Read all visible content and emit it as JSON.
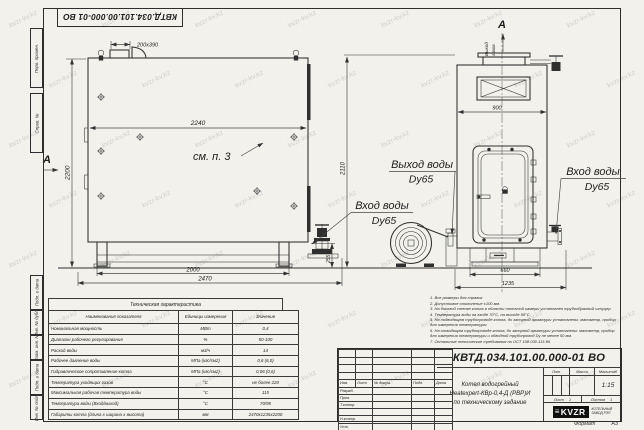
{
  "watermark": {
    "text": "kvzr-kv.kz"
  },
  "top_stamp": {
    "doc_number": "КВТД.034.101.00.000-01 ВО"
  },
  "frame_strip": {
    "labels": [
      "Перв. примен.",
      "Справ. №",
      "Подп. и дата",
      "Инв. № дубл.",
      "Взам. инв. №",
      "Подп. и дата",
      "Инв. № подл."
    ]
  },
  "drawing": {
    "section_letter": "А",
    "see_note": "см. п. 3",
    "gas_outlet_line1": "Выход",
    "gas_outlet_line2": "газов",
    "labels": {
      "inlet_line1": "Вход воды",
      "inlet_line2": "Dy65",
      "outlet_line1": "Выход воды",
      "outlet_line2": "Dy65"
    },
    "dims": {
      "front_top": "200x390",
      "front_inner_width": "2240",
      "front_height": "2200",
      "front_base": "2000",
      "front_total": "2470",
      "front_base_h": "255",
      "side_height": "2110",
      "side_width": "900",
      "side_base": "660",
      "side_total": "1235"
    }
  },
  "notes": [
    "1. Все размеры для справок",
    "2. Допустимое отклонение ±100 мм.",
    "3. На боковой стенке котла в области топочной камеры установлен трубообразный штуцер",
    "4. Температура воды на входе 70°С, на выходе 95°С.",
    "5. На подводящем трубопроводе котла, до запорной арматуры установлены: манометр, прибор для измерения температуры.",
    "6. На отводящем трубопроводе котла, до запорной арматуры установлены: манометр, прибор для измерения температуры и обводной трубопровод Dy не менее 50 мм.",
    "7. Остальные технические требования по ОСТ 108.030.113-86"
  ],
  "tech_table": {
    "title": "Техническая характеристика",
    "col_name": "Наименования показателя",
    "col_unit": "Единицы измерения",
    "col_value": "Значение",
    "rows": [
      {
        "name": "Номинальная мощность",
        "unit": "МВт",
        "value": "0,4"
      },
      {
        "name": "Диапазон рабочего регулирования",
        "unit": "%",
        "value": "50-100"
      },
      {
        "name": "Расход воды",
        "unit": "м3/ч",
        "value": "14"
      },
      {
        "name": "Рабочее давление воды",
        "unit": "МПа (кгс/см2)",
        "value": "0,6 (6,0)"
      },
      {
        "name": "Гидравлическое сопротивление котла",
        "unit": "МПа (кгс/см2)",
        "value": "0,06 (0,6)"
      },
      {
        "name": "Температура уходящих газов",
        "unit": "°С",
        "value": "не более 220"
      },
      {
        "name": "Максимальная рабочая температура воды",
        "unit": "°С",
        "value": "115"
      },
      {
        "name": "Температура воды (Вход/выход)",
        "unit": "°С",
        "value": "70/95"
      },
      {
        "name": "Габариты котла (длина х ширина х высота)",
        "unit": "мм",
        "value": "2470х1235х2200"
      }
    ]
  },
  "title_block": {
    "doc_number": "КВТД.034.101.00.000-01 ВО",
    "name_line1": "Котел водогрейный",
    "name_line2": "Heatexpert-КВр-0,4-Д (РВР)И",
    "name_line3": "по техническому задание",
    "header_cols": {
      "izm": "Изм.",
      "list": "Лист",
      "doc": "№ докум.",
      "podp": "Подп.",
      "data": "Дата"
    },
    "roles": [
      "Разраб.",
      "Пров.",
      "Т.контр.",
      "",
      "Н.контр.",
      "Утв."
    ],
    "lit_label": "Лит.",
    "mass_label": "Масса",
    "scale_label": "Масштаб",
    "scale_value": "1:15",
    "sheet_label": "Лист",
    "sheet_value": "1",
    "sheets_label": "Листов",
    "sheets_value": "1",
    "logo_text": "KVZR",
    "company_line1": "КОТЕЛЬНЫЙ",
    "company_line2": "ЗАВОД РЭП",
    "format_label": "Формат",
    "format_value": "А3"
  }
}
